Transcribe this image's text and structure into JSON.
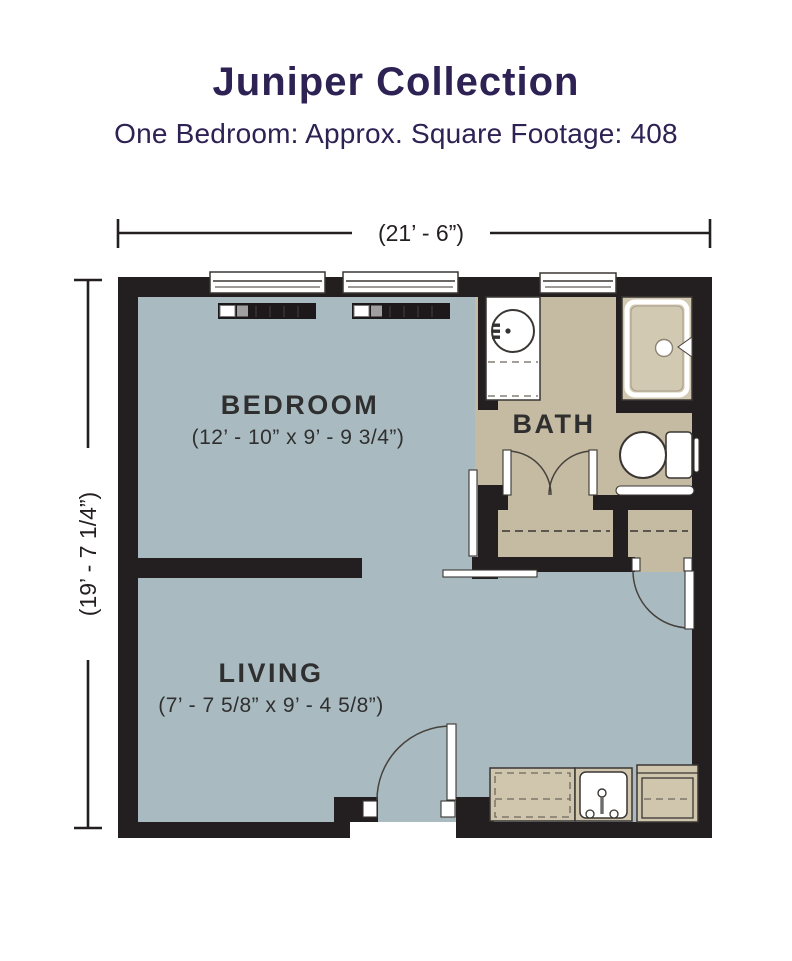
{
  "header": {
    "title": "Juniper Collection",
    "subtitle": "One Bedroom: Approx. Square Footage: 408"
  },
  "dimensions": {
    "overall_width": "(21’ - 6”)",
    "overall_height": "(19’ - 7 1/4”)"
  },
  "rooms": {
    "bedroom": {
      "label": "BEDROOM",
      "size": "(12’ - 10” x 9’ - 9 3/4”)"
    },
    "bath": {
      "label": "BATH"
    },
    "living": {
      "label": "LIVING",
      "size": "(7’ - 7 5/8” x 9’ - 4 5/8”)"
    }
  },
  "fixtures": [
    "window",
    "window",
    "bath-window",
    "baseboard-heater",
    "baseboard-heater",
    "vanity-round-sink",
    "shower-stall",
    "toilet",
    "grab-bar",
    "bath-double-doors",
    "closet-rod-left",
    "closet-rod-right",
    "closet-swing-door",
    "bedroom-sliding-door",
    "door-track",
    "entry-swing-door",
    "kitchen-counter",
    "kitchen-sink",
    "kitchen-appliance"
  ],
  "colors": {
    "title_navy": "#2e2153",
    "wall": "#231f20",
    "floor_main": "#a9bbc1",
    "floor_bath": "#c5bba2",
    "fixture_tan": "#d0c6ae",
    "shower_tan": "#d2c9b3",
    "line_dark": "#3a3633",
    "label": "#2f2f2f"
  }
}
